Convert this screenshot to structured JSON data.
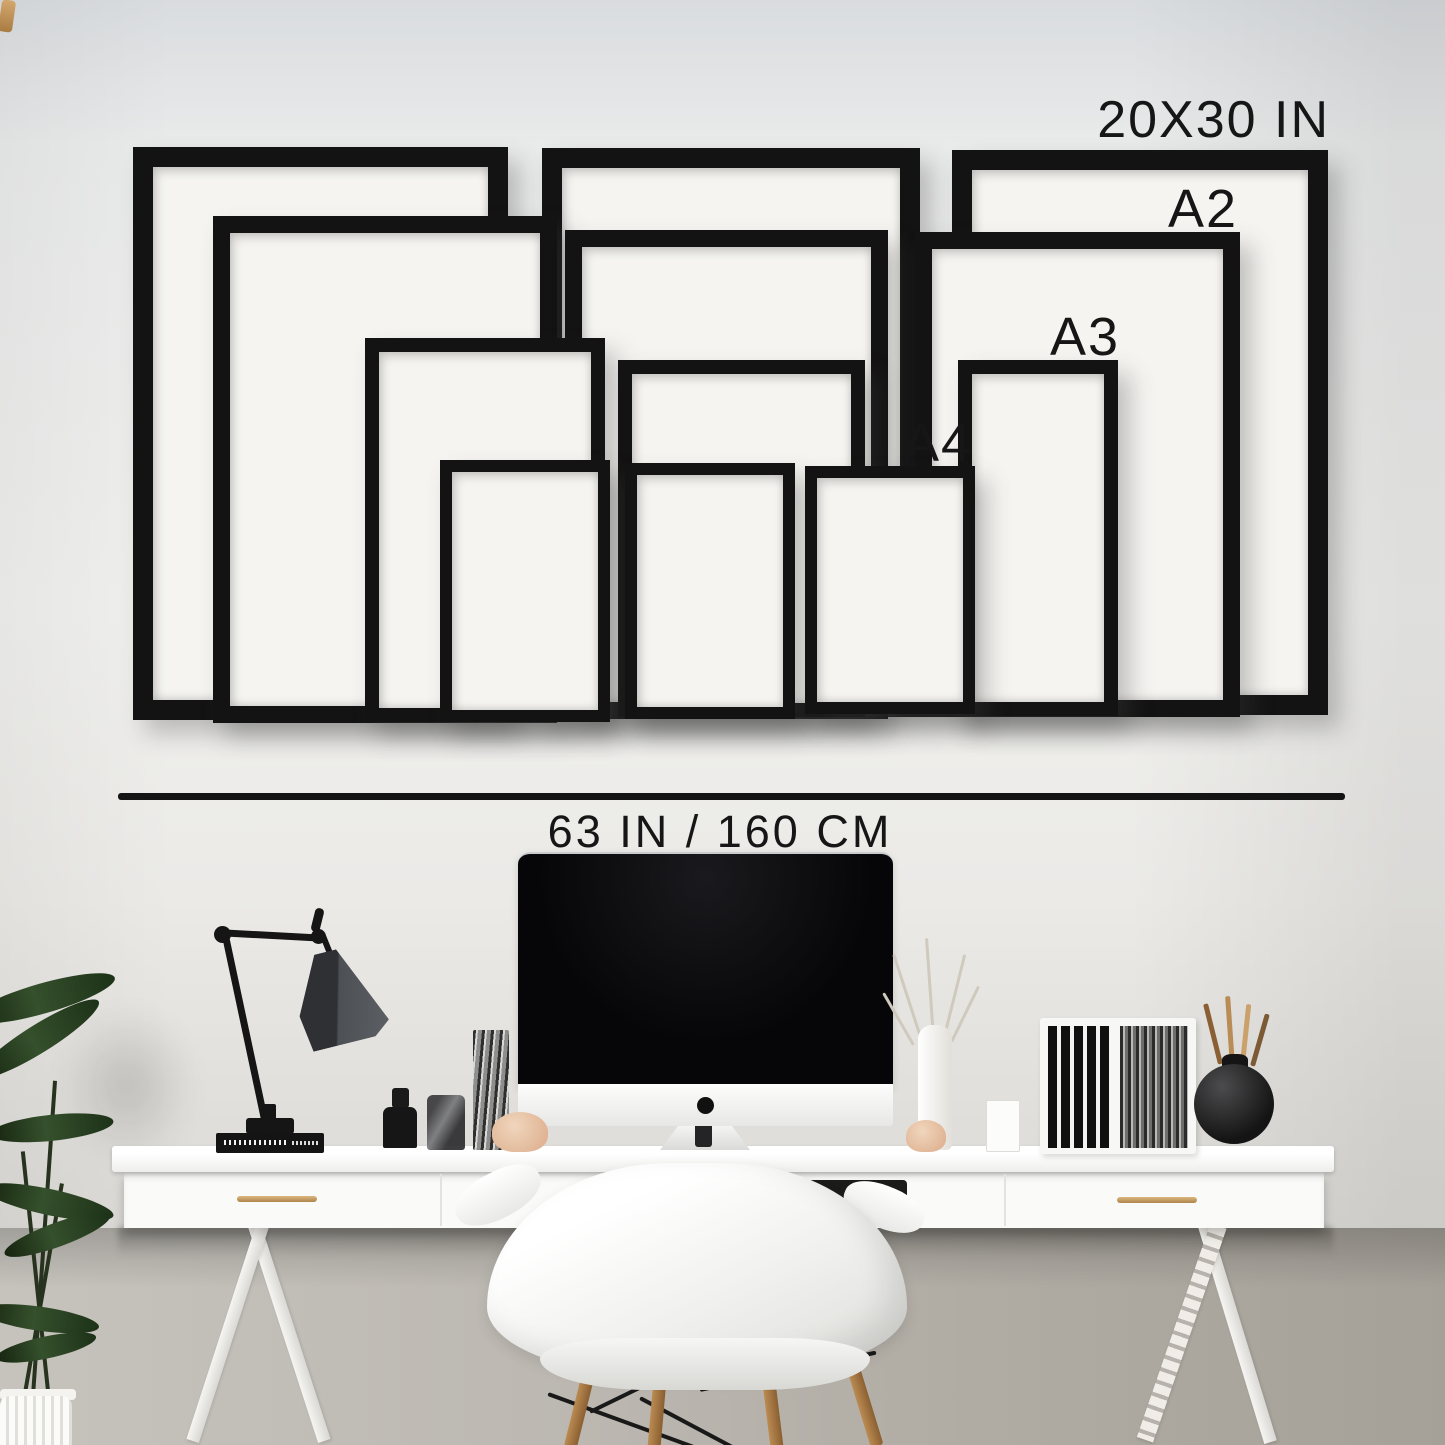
{
  "size_guide": {
    "sizes": [
      {
        "label": "20X30 IN",
        "count": 3
      },
      {
        "label": "A2",
        "count": 3
      },
      {
        "label": "A3",
        "count": 3
      },
      {
        "label": "A4",
        "count": 3
      }
    ],
    "wall_width_label": "63 IN / 160 CM"
  },
  "colors": {
    "wall": "#ECEDEC",
    "lower_wall": "#B1ADA5",
    "frame": "#131313",
    "mat": "#F5F4F1",
    "text": "#161616",
    "measure_line": "#141414",
    "desk": "#FAFAF8",
    "brass_handle": "#C49A62",
    "chair": "#F2F2F0",
    "wood_leg": "#A87C48",
    "plant": "#2C4A2E",
    "screen": "#0A0A0C"
  }
}
